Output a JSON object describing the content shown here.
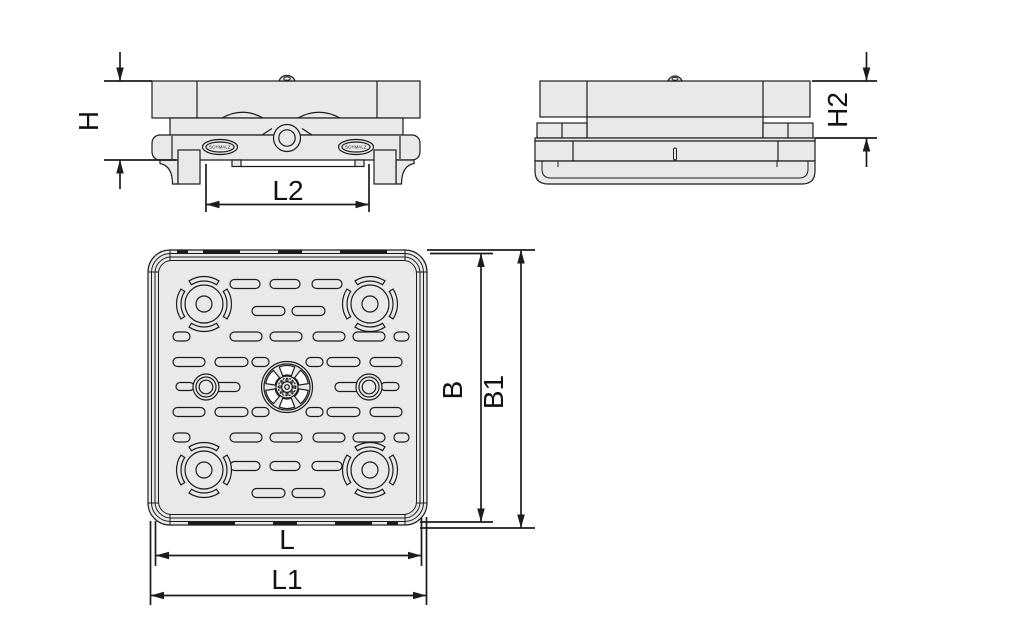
{
  "drawing": {
    "dimension_labels": {
      "h": "H",
      "l2": "L2",
      "h2": "H2",
      "b": "B",
      "b1": "B1",
      "l": "L",
      "l1": "L1"
    },
    "badge_text": "SCHMALZ",
    "colors": {
      "body_fill": "#e9e9e9",
      "line": "#1c1c1c",
      "background": "#ffffff"
    }
  }
}
